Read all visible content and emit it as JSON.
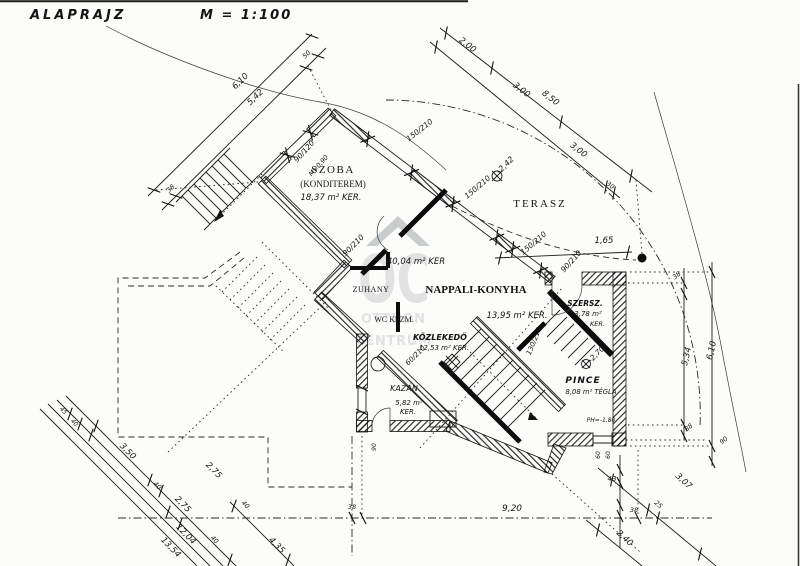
{
  "page": {
    "title": "ALAPRAJZ",
    "scale": "M = 1:100"
  },
  "watermark": {
    "letters": "OC",
    "word1": "OTTHON",
    "word2": "CENTRUM"
  },
  "rooms": {
    "szoba": {
      "name": "SZOBA",
      "alt": "(KONDITEREM)",
      "area": "18,37 m² KER."
    },
    "terasz": {
      "name": "TERASZ",
      "level": "-2,42"
    },
    "nappali": {
      "name": "NAPPALI-KONYHA",
      "area": "13,95 m² KER.",
      "area_total": "40,04 m² KER"
    },
    "zuhany": {
      "name": "ZUHANY"
    },
    "wc": {
      "name": "WC KÉZM."
    },
    "kozlekedo": {
      "name": "KÖZLEKEDŐ",
      "area": "12,53 m² KER."
    },
    "kazan": {
      "name": "KAZÁN",
      "area": "5,82 m²",
      "finish": "KER."
    },
    "szerszamos": {
      "name": "SZERSZ.",
      "area": "3,78 m²",
      "finish": "KER."
    },
    "pince": {
      "name": "PINCE",
      "area": "8,08 m² TÉGLA",
      "floor_level": "PH=-1,80",
      "stair_level": "-2,70"
    }
  },
  "openings": {
    "window_large_1": "150/210",
    "window_large_2": "150/210",
    "window_large_3": "150/210",
    "window_szoba": "90/120",
    "parapet": "M=0,90",
    "door_szoba": "90/210",
    "door_entrance": "90/210",
    "door_kozlekedo": "60/210",
    "door_pince": "130/210",
    "window_small_a": "60",
    "window_small_b": "60",
    "door_kazan": "90"
  },
  "dimensions": {
    "top_left": {
      "total": "6,10",
      "inner": "5,42",
      "offset": "50",
      "wall": "38"
    },
    "top_right": {
      "seg1": "2,00",
      "seg2": "3,00",
      "seg3": "3,00",
      "total": "8,50",
      "wall": "30"
    },
    "right": {
      "wall_top": "38",
      "inner": "5,34",
      "total": "6,10",
      "wall_bottom": "38"
    },
    "bottom_left": {
      "seg1": "3,50",
      "w1": "40",
      "seg2": "2,75",
      "w2": "40",
      "seg3": "2,75",
      "w3": "40",
      "total1": "12,04",
      "total2": "13,54",
      "ext": "4,35",
      "o1": "45",
      "o2": "40"
    },
    "bottom": {
      "wall": "38",
      "total": "9,20"
    },
    "bottom_right": {
      "a": "43",
      "b": "38",
      "c": "25",
      "diag1": "3,07",
      "diag2": "2,40",
      "post": "90"
    },
    "entrance": {
      "width": "1,65"
    }
  }
}
